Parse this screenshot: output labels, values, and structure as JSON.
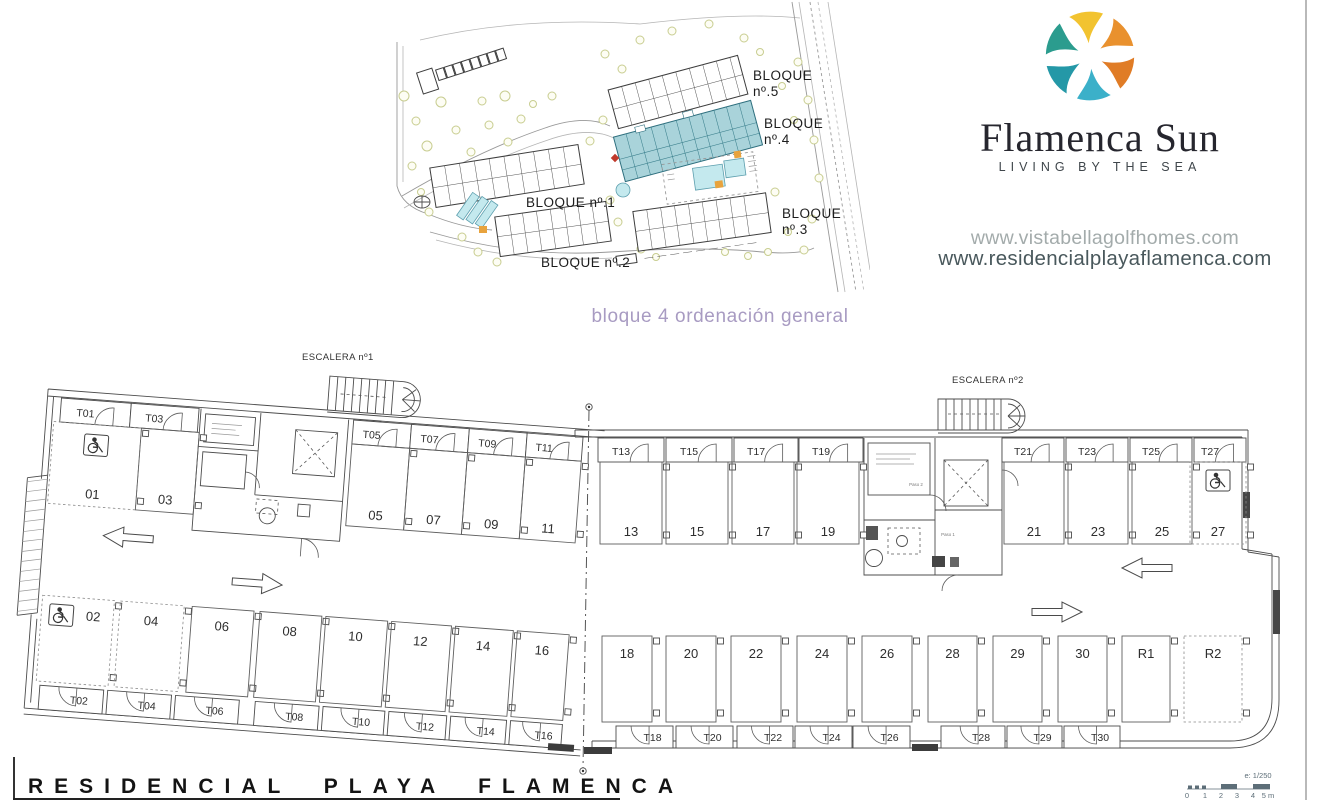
{
  "brand": {
    "name": "Flamenca Sun",
    "tagline": "LIVING BY THE SEA",
    "url_primary": "www.vistabellagolfhomes.com",
    "url_secondary": "www.residencialplayaflamenca.com"
  },
  "site_plan": {
    "caption": "bloque 4 ordenación general",
    "block1_label": "BLOQUE nº.1",
    "block2_label": "BLOQUE nº.2",
    "block3_label_line1": "BLOQUE",
    "block3_label_line2": "nº.3",
    "block4_label_line1": "BLOQUE",
    "block4_label_line2": "nº.4",
    "block5_label_line1": "BLOQUE",
    "block5_label_line2": "nº.5"
  },
  "floor_plan": {
    "escalera1": "ESCALERA nº1",
    "escalera2": "ESCALERA nº2",
    "storage_row_a": [
      "T01",
      "T03",
      "T05",
      "T07",
      "T09",
      "T11"
    ],
    "parking_row_a": [
      "01",
      "03",
      "05",
      "07",
      "09",
      "11"
    ],
    "storage_row_b": [
      "T13",
      "T15",
      "T17",
      "T19"
    ],
    "parking_row_b": [
      "13",
      "15",
      "17",
      "19"
    ],
    "storage_row_c": [
      "T21",
      "T23",
      "T25",
      "T27"
    ],
    "parking_row_c": [
      "21",
      "23",
      "25",
      "27"
    ],
    "parking_row_d": [
      "02",
      "04",
      "06",
      "08",
      "10",
      "12",
      "14",
      "16"
    ],
    "storage_row_d": [
      "T02",
      "T04",
      "T06",
      "T08",
      "T10",
      "T12",
      "T14",
      "T16"
    ],
    "parking_row_e": [
      "18",
      "20",
      "22",
      "24",
      "26",
      "28",
      "29",
      "30",
      "R1",
      "R2"
    ],
    "storage_row_e": [
      "T18",
      "T20",
      "T22",
      "T24",
      "T26",
      "T28",
      "T29",
      "T30"
    ],
    "micro_label_paso1": "Paso 1",
    "micro_label_paso2": "Paso 2"
  },
  "scale_bar": {
    "ratio": "e: 1/250",
    "ticks": [
      "0",
      "1",
      "2",
      "3",
      "4",
      "5 m"
    ]
  },
  "footer": {
    "title": "RESIDENCIAL PLAYA FLAMENCA"
  },
  "colors": {
    "block4_fill": "#a9d3da",
    "pool": "#c4e9ee",
    "logo_yellow": "#f2c330",
    "logo_orange": "#e9912e",
    "logo_teal": "#2b9c8e",
    "logo_blue": "#3bb0c9",
    "caption_text": "#a89bc2"
  }
}
